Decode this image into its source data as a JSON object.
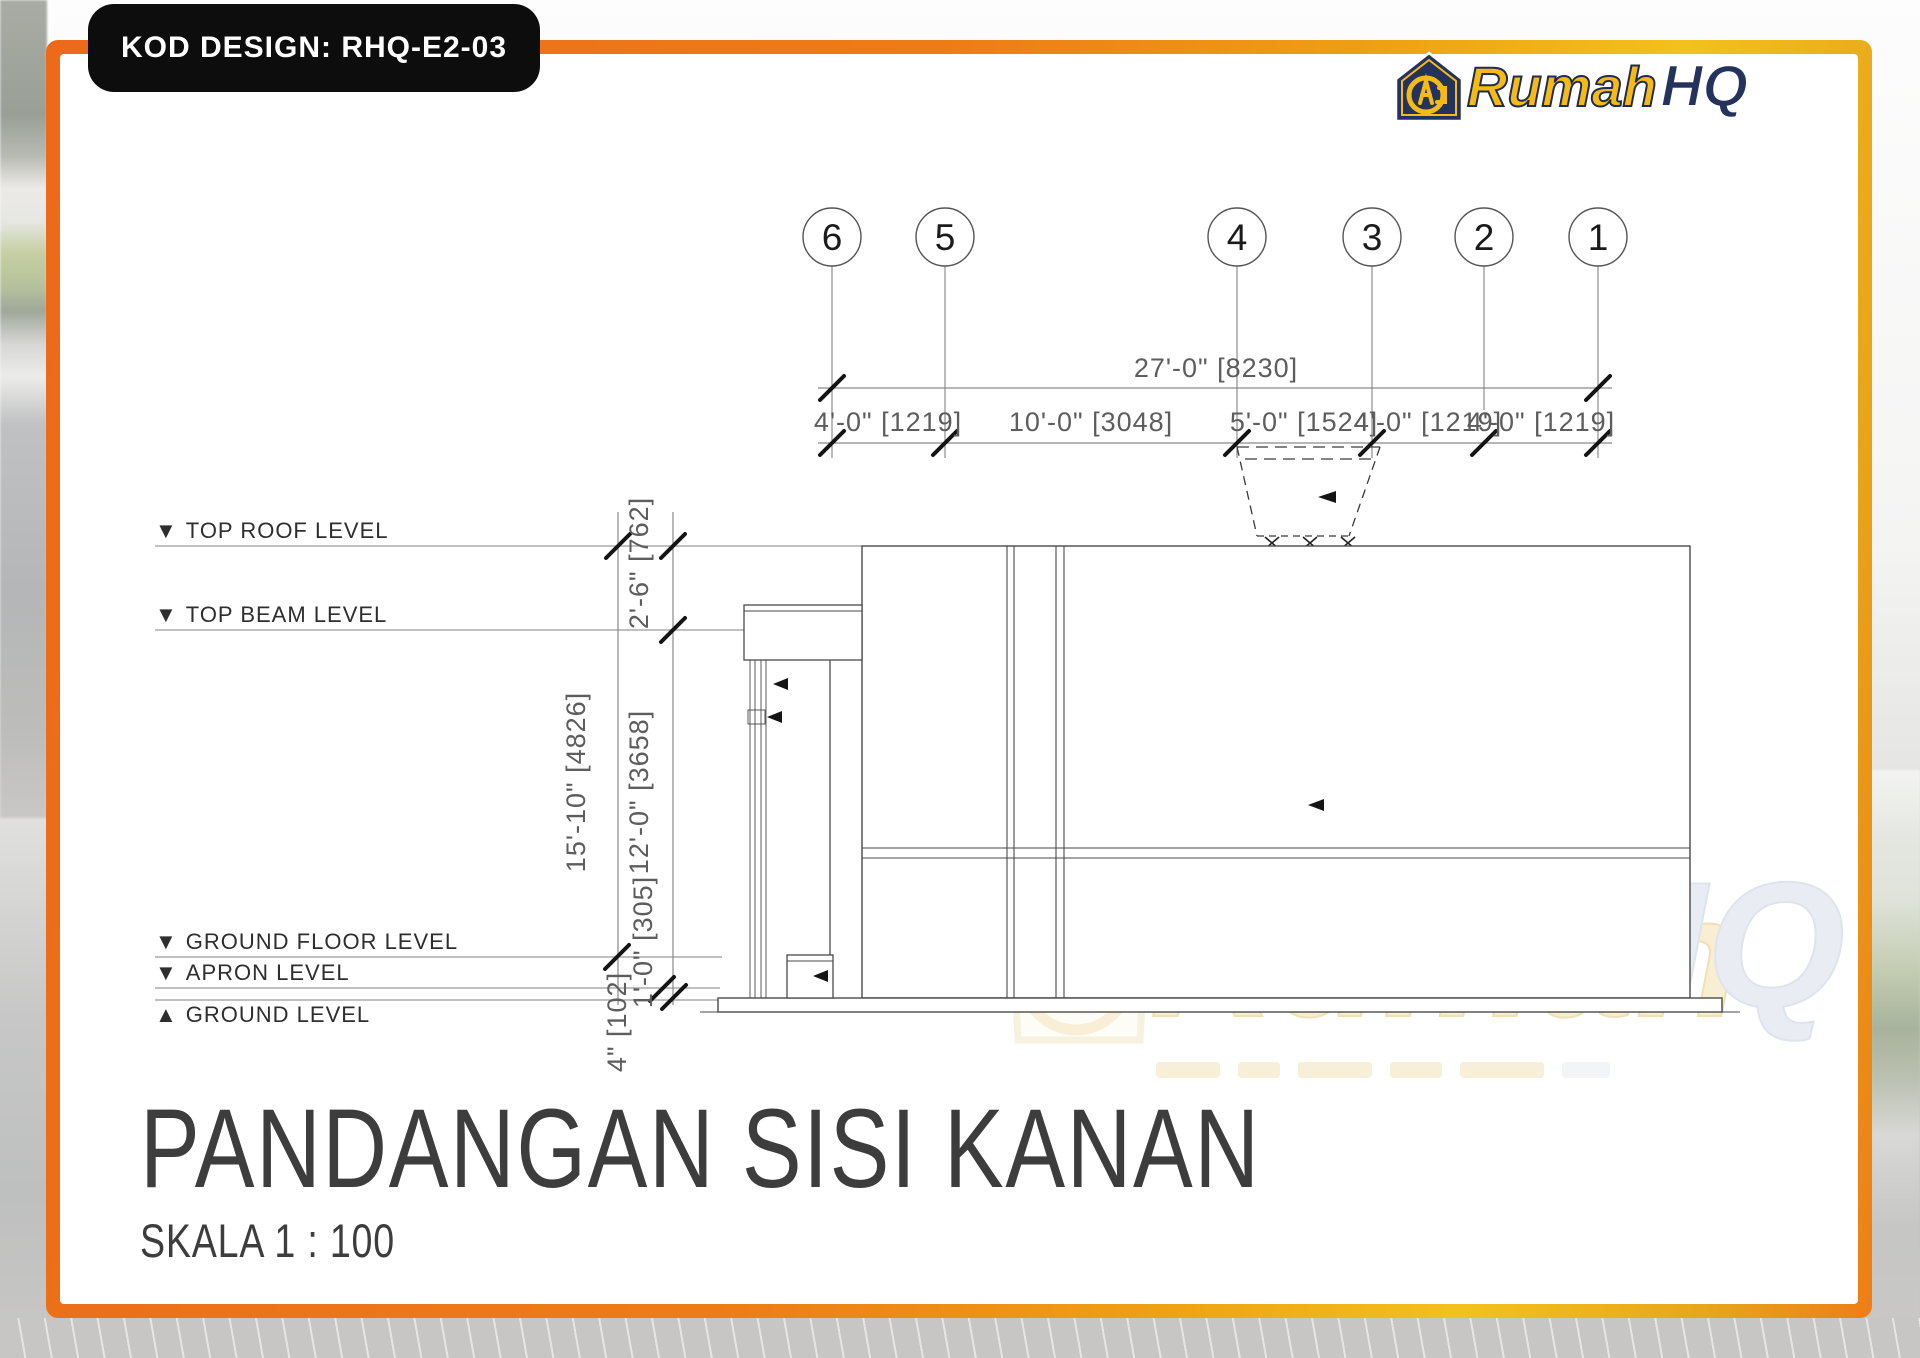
{
  "banner": {
    "text": "KOD DESIGN: RHQ-E2-03"
  },
  "logo": {
    "word_primary": "Rumah",
    "word_secondary": "HQ",
    "monogram": "HQ"
  },
  "drawing": {
    "grid_bubbles": [
      "6",
      "5",
      "4",
      "3",
      "2",
      "1"
    ],
    "dim_overall": "27'-0\" [8230]",
    "dim_segments": [
      "4'-0\" [1219]",
      "10'-0\" [3048]",
      "5'-0\" [1524]",
      "4'-0\" [1219]",
      "4'-0\" [1219]"
    ],
    "dims_vertical": {
      "overall": "15'-10\" [4826]",
      "roof_to_beam": "2'-6\" [762]",
      "beam_to_floor": "12'-0\" [3658]",
      "floor_to_apron": "1'-0\" [305]",
      "apron_to_ground": "4\" [102]"
    },
    "levels": [
      {
        "marker": "▼",
        "name": "TOP ROOF LEVEL"
      },
      {
        "marker": "▼",
        "name": "TOP BEAM LEVEL"
      },
      {
        "marker": "▼",
        "name": "GROUND FLOOR LEVEL"
      },
      {
        "marker": "▼",
        "name": "APRON LEVEL"
      },
      {
        "marker": "▲",
        "name": "GROUND LEVEL"
      }
    ]
  },
  "watermark": {
    "word_primary": "Rumah",
    "word_secondary": "HQ"
  },
  "title_block": {
    "title": "PANDANGAN SISI KANAN",
    "scale": "SKALA 1 : 100"
  },
  "colors": {
    "frame_orange": "#ec6a1a",
    "frame_gold": "#f3c11d",
    "banner_bg": "#0d0d0d",
    "logo_gold": "#f6ba17",
    "logo_navy": "#24335c",
    "line_gray": "#555555",
    "dim_text_gray": "#5d5d5d"
  }
}
